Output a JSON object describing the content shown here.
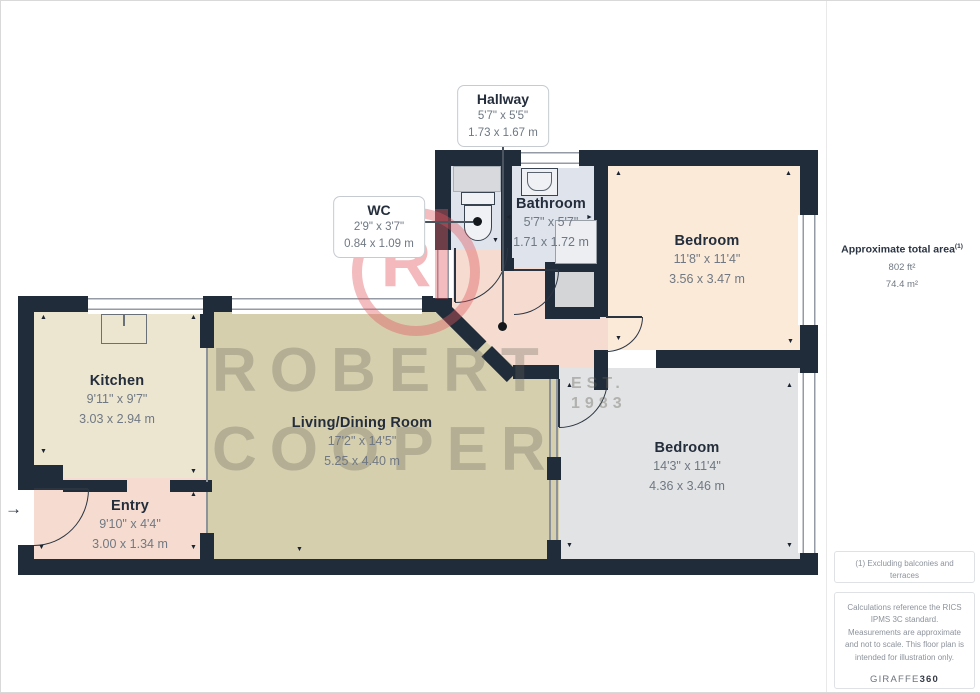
{
  "rooms": [
    {
      "name": "Hallway",
      "dims_ft": "5'7\" x 5'5\"",
      "dims_m": "1.73 x 1.67 m"
    },
    {
      "name": "WC",
      "dims_ft": "2'9\" x 3'7\"",
      "dims_m": "0.84 x 1.09 m"
    },
    {
      "name": "Bathroom",
      "dims_ft": "5'7\" x 5'7\"",
      "dims_m": "1.71 x 1.72 m"
    },
    {
      "name": "Bedroom",
      "dims_ft": "11'8\" x 11'4\"",
      "dims_m": "3.56 x 3.47 m"
    },
    {
      "name": "Kitchen",
      "dims_ft": "9'11\" x 9'7\"",
      "dims_m": "3.03 x 2.94 m"
    },
    {
      "name": "Living/Dining Room",
      "dims_ft": "17'2\" x 14'5\"",
      "dims_m": "5.25 x 4.40 m"
    },
    {
      "name": "Entry",
      "dims_ft": "9'10\" x 4'4\"",
      "dims_m": "3.00 x 1.34 m"
    },
    {
      "name": "Bedroom",
      "dims_ft": "14'3\" x 11'4\"",
      "dims_m": "4.36 x 3.46 m"
    }
  ],
  "sidebar": {
    "area_title": "Approximate total area",
    "area_sup": "(1)",
    "area_ft": "802 ft²",
    "area_m": "74.4 m²"
  },
  "footer": {
    "note1": "(1) Excluding balconies and terraces",
    "note2": "Calculations reference the RICS IPMS 3C standard. Measurements are approximate and not to scale. This floor plan is intended for illustration only.",
    "brand": "GIRAFFE",
    "brand_suffix": "360"
  },
  "watermark": {
    "line1": "ROBERT",
    "line2": "COOPER",
    "est": "EST.",
    "year": "1983",
    "logo_letter": "R"
  },
  "glyphs": {
    "up": "▲",
    "down": "▼",
    "left": "◄",
    "right": "►",
    "entry_arrow": "→"
  },
  "plan_markers": [
    {
      "x": 40,
      "y": 314,
      "g": "up"
    },
    {
      "x": 190,
      "y": 314,
      "g": "up"
    },
    {
      "x": 40,
      "y": 448,
      "g": "down"
    },
    {
      "x": 190,
      "y": 468,
      "g": "down"
    },
    {
      "x": 38,
      "y": 544,
      "g": "down"
    },
    {
      "x": 190,
      "y": 491,
      "g": "up"
    },
    {
      "x": 190,
      "y": 544,
      "g": "down"
    },
    {
      "x": 296,
      "y": 546,
      "g": "down"
    },
    {
      "x": 615,
      "y": 170,
      "g": "up"
    },
    {
      "x": 785,
      "y": 170,
      "g": "up"
    },
    {
      "x": 615,
      "y": 335,
      "g": "down"
    },
    {
      "x": 787,
      "y": 338,
      "g": "down"
    },
    {
      "x": 566,
      "y": 382,
      "g": "up"
    },
    {
      "x": 786,
      "y": 382,
      "g": "up"
    },
    {
      "x": 566,
      "y": 542,
      "g": "down"
    },
    {
      "x": 786,
      "y": 542,
      "g": "down"
    },
    {
      "x": 505,
      "y": 214,
      "g": "left"
    },
    {
      "x": 586,
      "y": 214,
      "g": "right"
    },
    {
      "x": 492,
      "y": 237,
      "g": "down"
    }
  ],
  "colors": {
    "wall": "#212c3a",
    "kitchen": "#ece6d1",
    "living": "#d6cfae",
    "entry_hall": "#f6dcd0",
    "bedroom1": "#fcead9",
    "bedroom2": "#e2e3e4",
    "wet_rooms": "#dfe3ec",
    "logo_pink": "#e45860"
  }
}
